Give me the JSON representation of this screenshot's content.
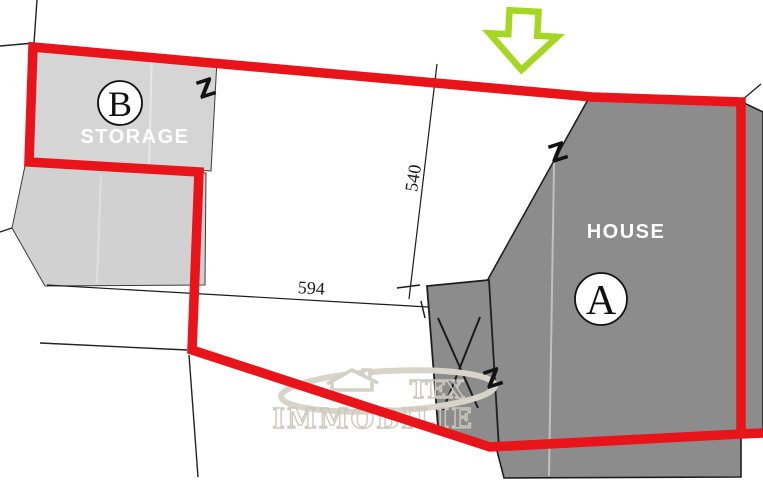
{
  "plan": {
    "title_note": "site plan",
    "colors": {
      "boundary_red": "#e8141a",
      "parcel_light": "#d5d5d5",
      "parcel_light2": "#d1d1d1",
      "parcel_dark": "#8c8c8c",
      "arrow_green": "#a5d622",
      "watermark": "#ccc8bd",
      "ink": "#1b1b1b"
    },
    "parcels": [
      {
        "letter": "A",
        "label": "HOUSE"
      },
      {
        "letter": "B",
        "label": "STORAGE"
      }
    ],
    "dimensions": [
      {
        "value": "540"
      },
      {
        "value": "594"
      }
    ],
    "fence_symbol": "Z",
    "watermark": {
      "line1": "TEX",
      "line2": "IMMOBILIE"
    }
  }
}
